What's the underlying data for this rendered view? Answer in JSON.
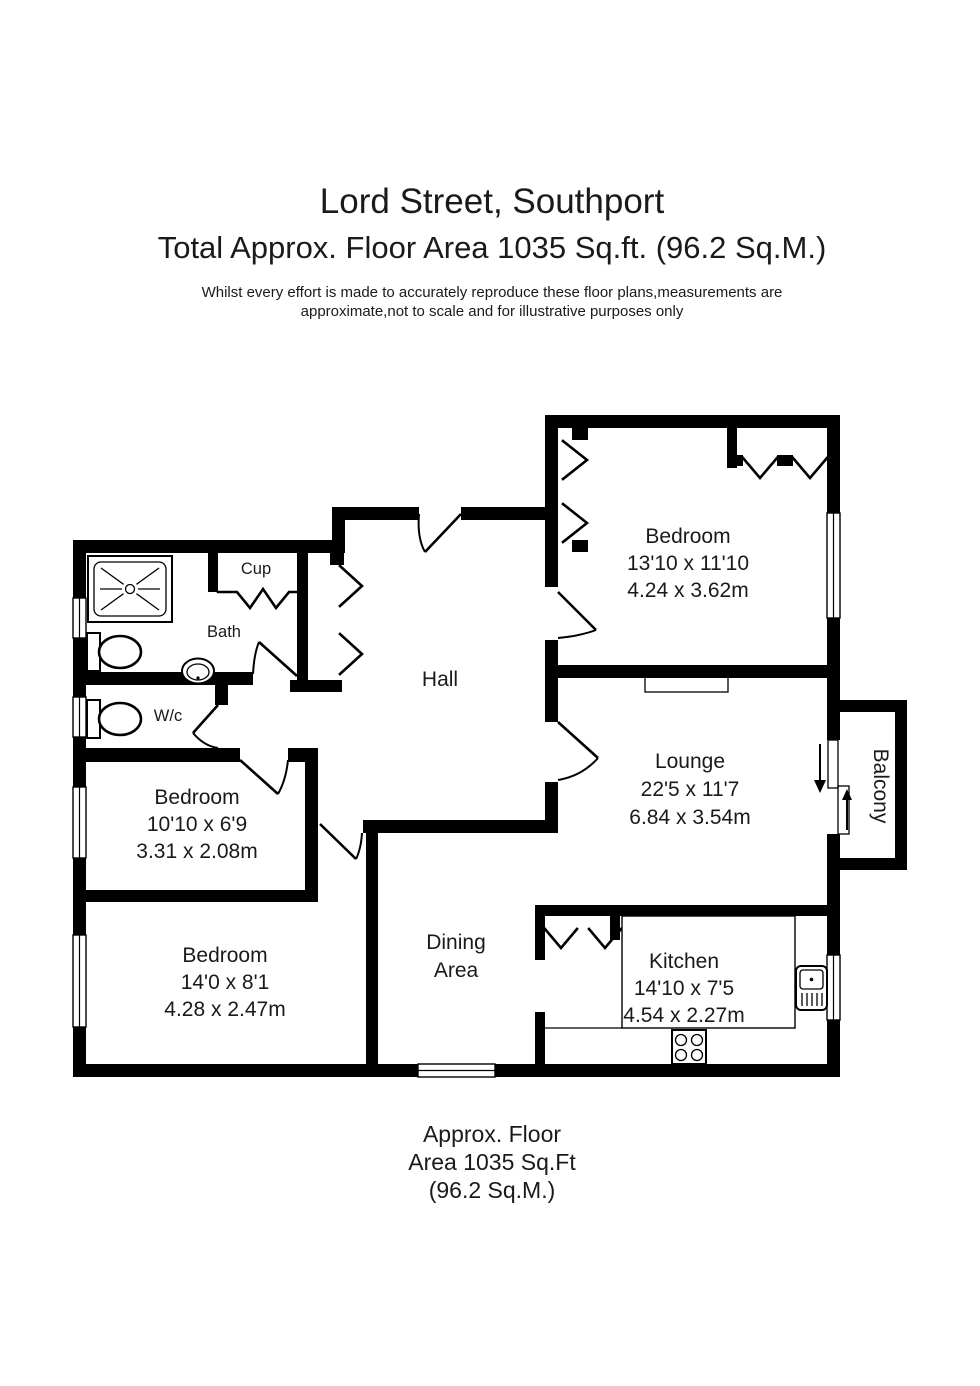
{
  "header": {
    "title": "Lord Street, Southport",
    "subtitle": "Total Approx. Floor Area 1035 Sq.ft. (96.2 Sq.M.)",
    "disclaimer_line1": "Whilst every effort is made to accurately reproduce these floor plans,measurements are",
    "disclaimer_line2": "approximate,not to scale and for illustrative purposes only"
  },
  "rooms": {
    "bedroom1": {
      "name": "Bedroom",
      "imperial": "13'10 x 11'10",
      "metric": "4.24 x 3.62m"
    },
    "lounge": {
      "name": "Lounge",
      "imperial": "22'5 x 11'7",
      "metric": "6.84 x 3.54m"
    },
    "kitchen": {
      "name": "Kitchen",
      "imperial": "14'10 x 7'5",
      "metric": "4.54 x 2.27m"
    },
    "dining": {
      "line1": "Dining",
      "line2": "Area"
    },
    "bedroom2": {
      "name": "Bedroom",
      "imperial": "10'10 x 6'9",
      "metric": "3.31 x 2.08m"
    },
    "bedroom3": {
      "name": "Bedroom",
      "imperial": "14'0 x 8'1",
      "metric": "4.28 x 2.47m"
    },
    "hall": {
      "name": "Hall"
    },
    "bath": {
      "name": "Bath"
    },
    "cup": {
      "name": "Cup"
    },
    "wc": {
      "name": "W/c"
    },
    "balcony": {
      "name": "Balcony"
    }
  },
  "footer": {
    "line1": "Approx. Floor",
    "line2": "Area 1035 Sq.Ft",
    "line3": "(96.2 Sq.M.)"
  },
  "colors": {
    "wall": "#000000",
    "text": "#1a1a1a",
    "background": "#ffffff"
  }
}
